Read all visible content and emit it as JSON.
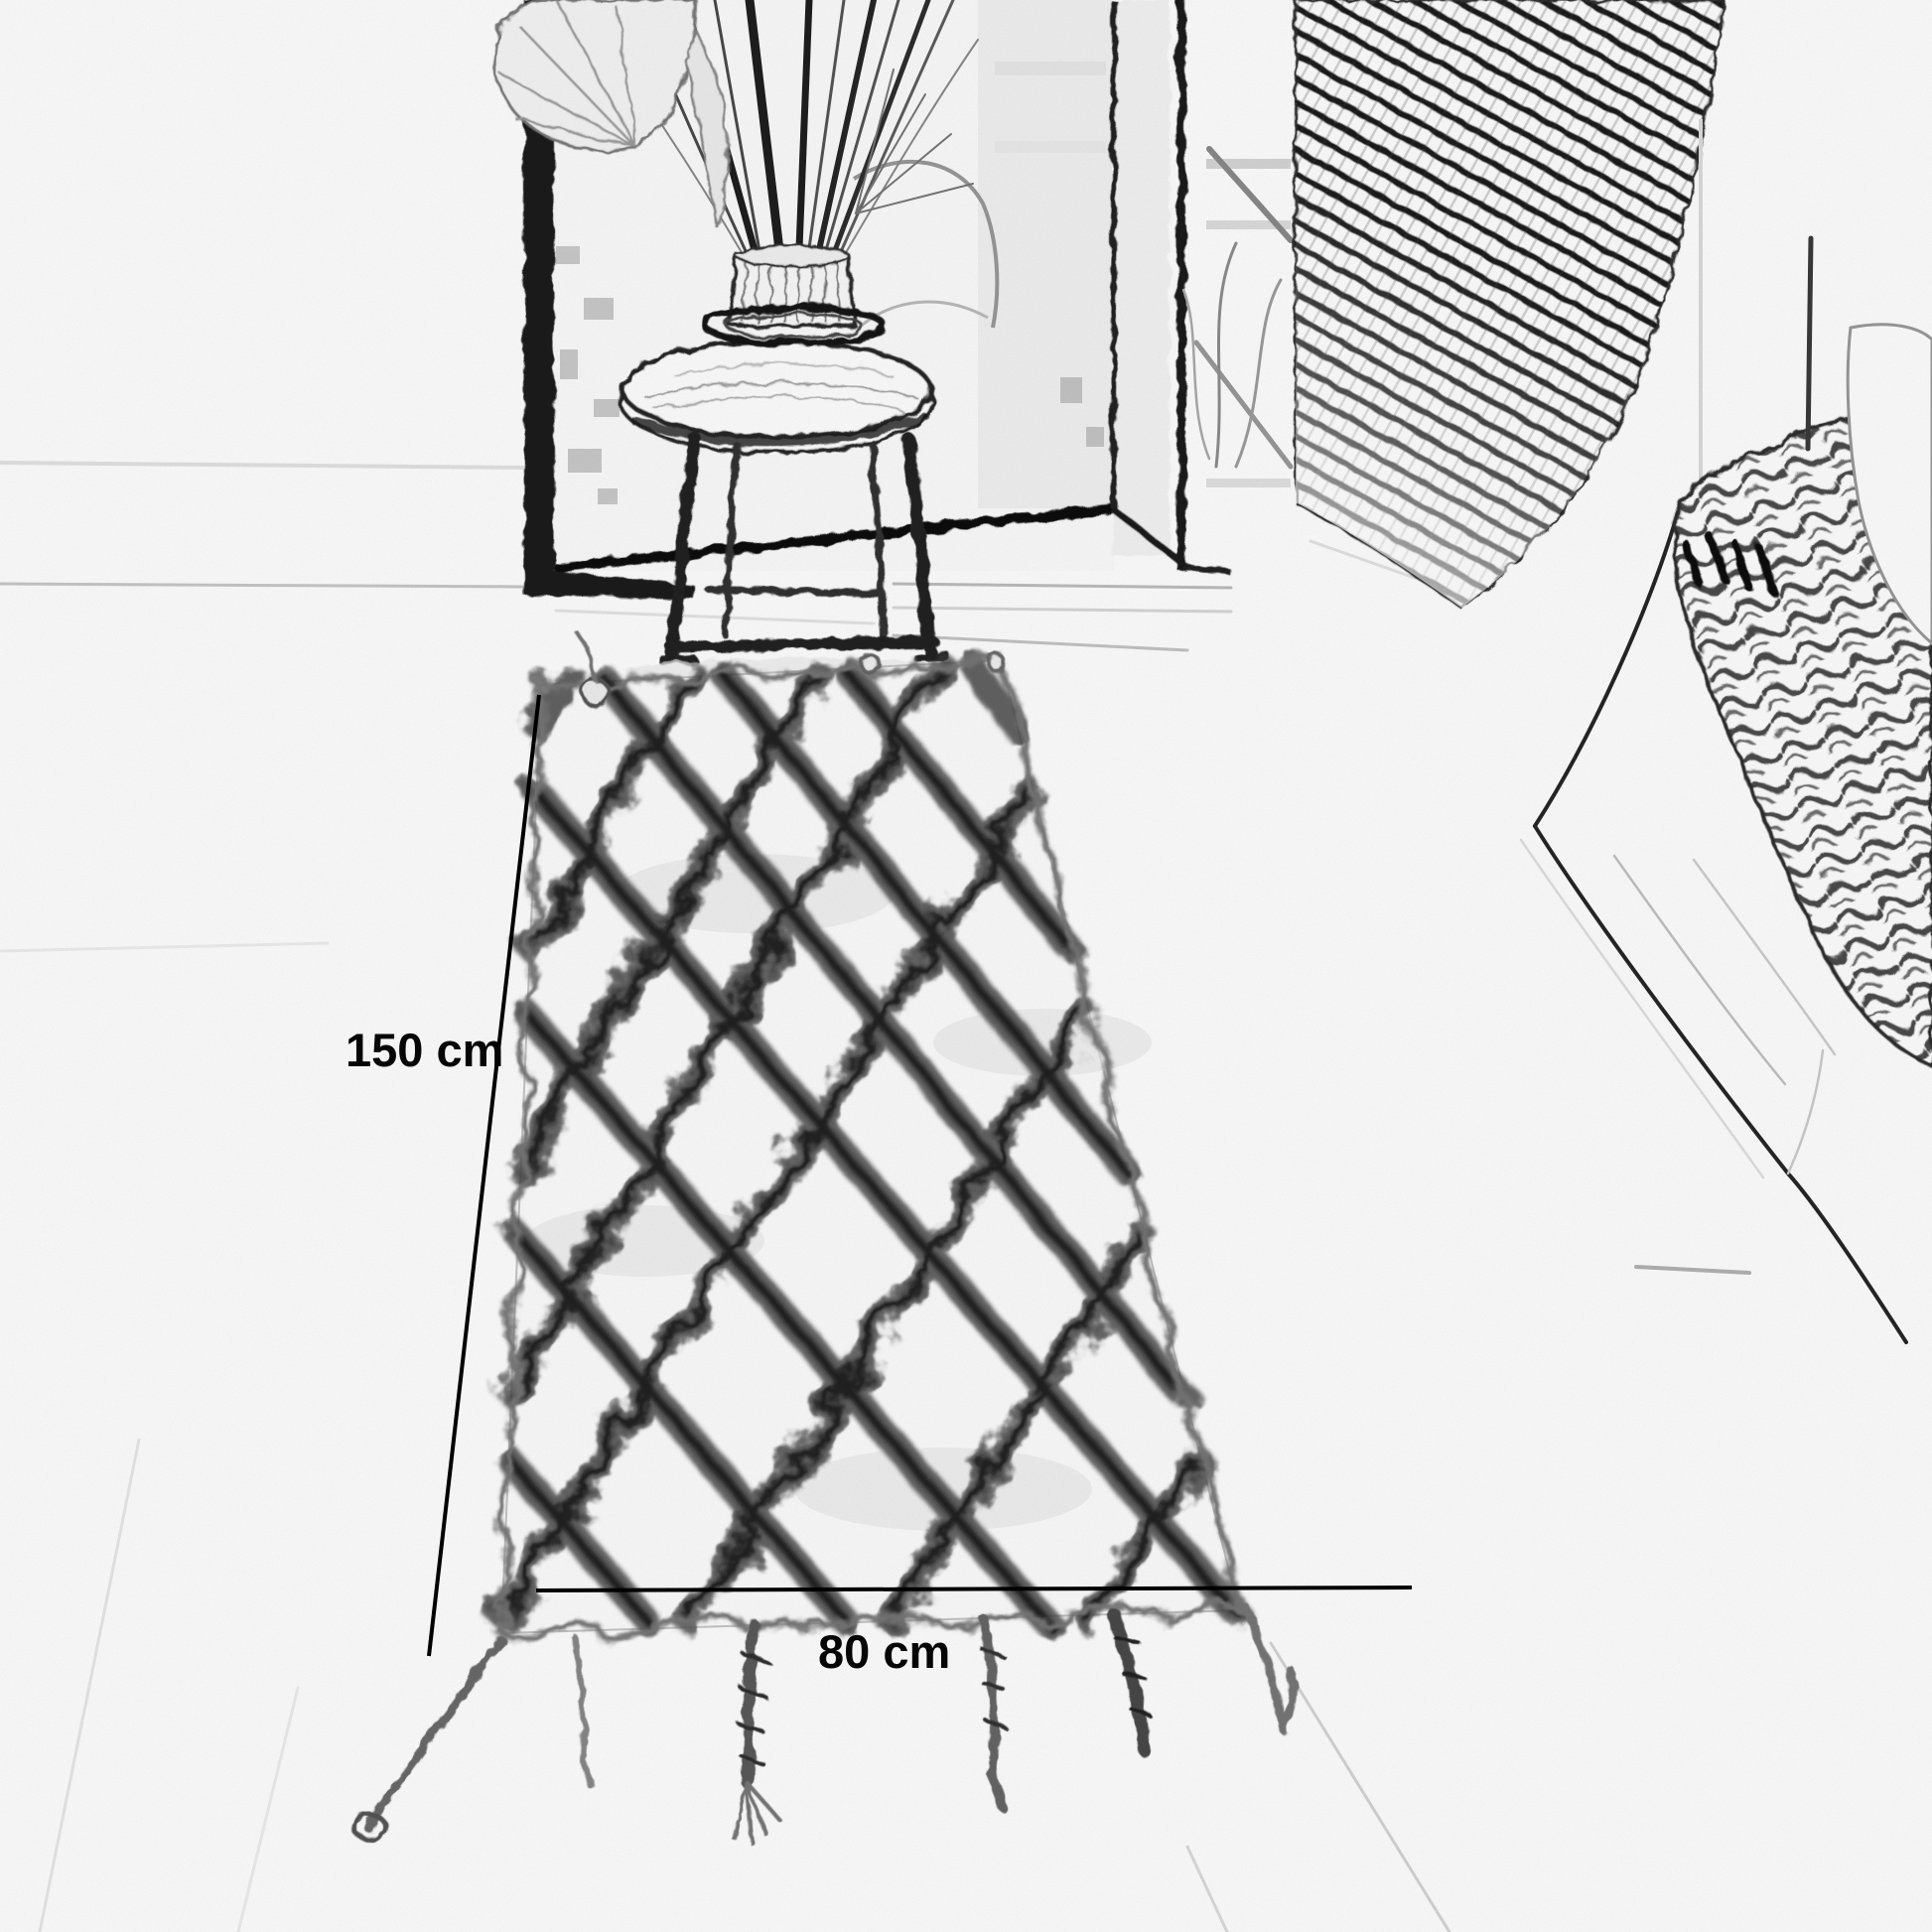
{
  "page": {
    "title": "Rug product photo (sketch style)",
    "type": "annotated product image"
  },
  "annotations": {
    "length_label": "150 cm",
    "width_label": "80 cm"
  },
  "scene": {
    "style": "pencil-sketch photo effect",
    "objects": [
      "leaning floor mirror",
      "dried-grass bouquet in fluted vase",
      "round wooden stool",
      "rattan screen panel",
      "white sofa with chunky-knit throw",
      "berber diamond-lattice rug with braided tassels",
      "light wood floor"
    ]
  },
  "colors": {
    "background": "#ffffff",
    "ink": "#000000",
    "sketch_dark": "#2b2b2b",
    "sketch_mid": "#888888",
    "sketch_light": "#d9d9d9"
  }
}
